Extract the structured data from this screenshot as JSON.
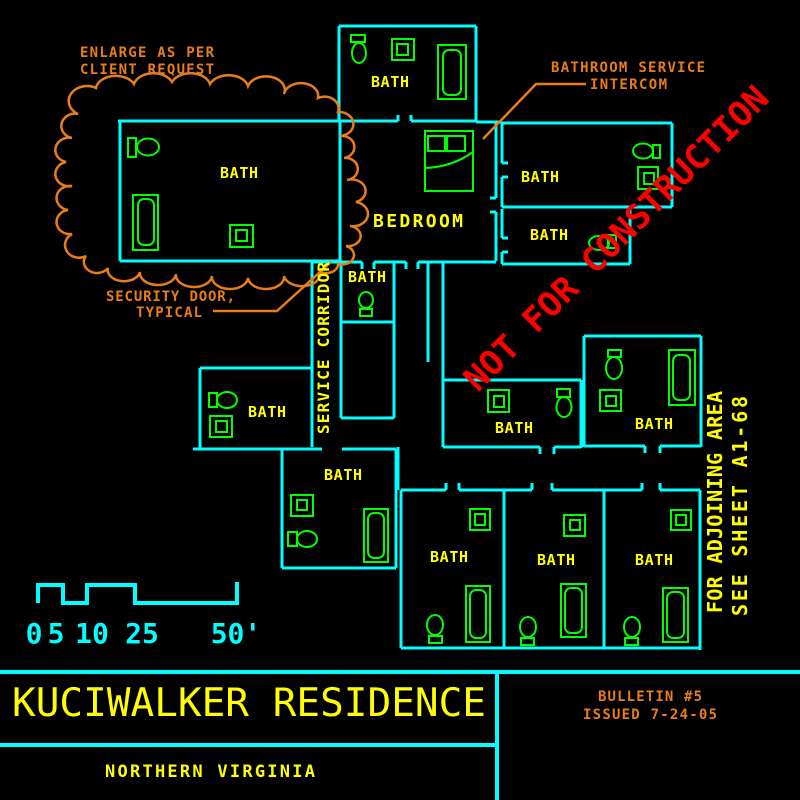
{
  "labels": {
    "bath": "BATH",
    "bedroom": "BEDROOM",
    "service_corridor": "SERVICE CORRIDOR"
  },
  "annotations": {
    "enlarge1": "ENLARGE AS PER",
    "enlarge2": "CLIENT REQUEST",
    "intercom1": "BATHROOM SERVICE",
    "intercom2": "INTERCOM",
    "security1": "SECURITY DOOR,",
    "security2": "TYPICAL"
  },
  "stamp": {
    "text": "NOT FOR CONSTRUCTION"
  },
  "side_note": {
    "line1": "FOR ADJOINING AREA",
    "line2": "SEE SHEET A1-68"
  },
  "scale_bar": {
    "labels": [
      "0",
      "5",
      "10",
      "25",
      "50'"
    ]
  },
  "title_block": {
    "title": "KUCIWALKER RESIDENCE",
    "location": "NORTHERN VIRGINIA",
    "bulletin1": "BULLETIN #5",
    "bulletin2": "ISSUED 7-24-05"
  },
  "colors": {
    "background": "#000000",
    "wall": "#00ffff",
    "fixture": "#00ff00",
    "room_label": "#ffff00",
    "annotation": "#e87d1a",
    "stamp": "#ff0000"
  }
}
